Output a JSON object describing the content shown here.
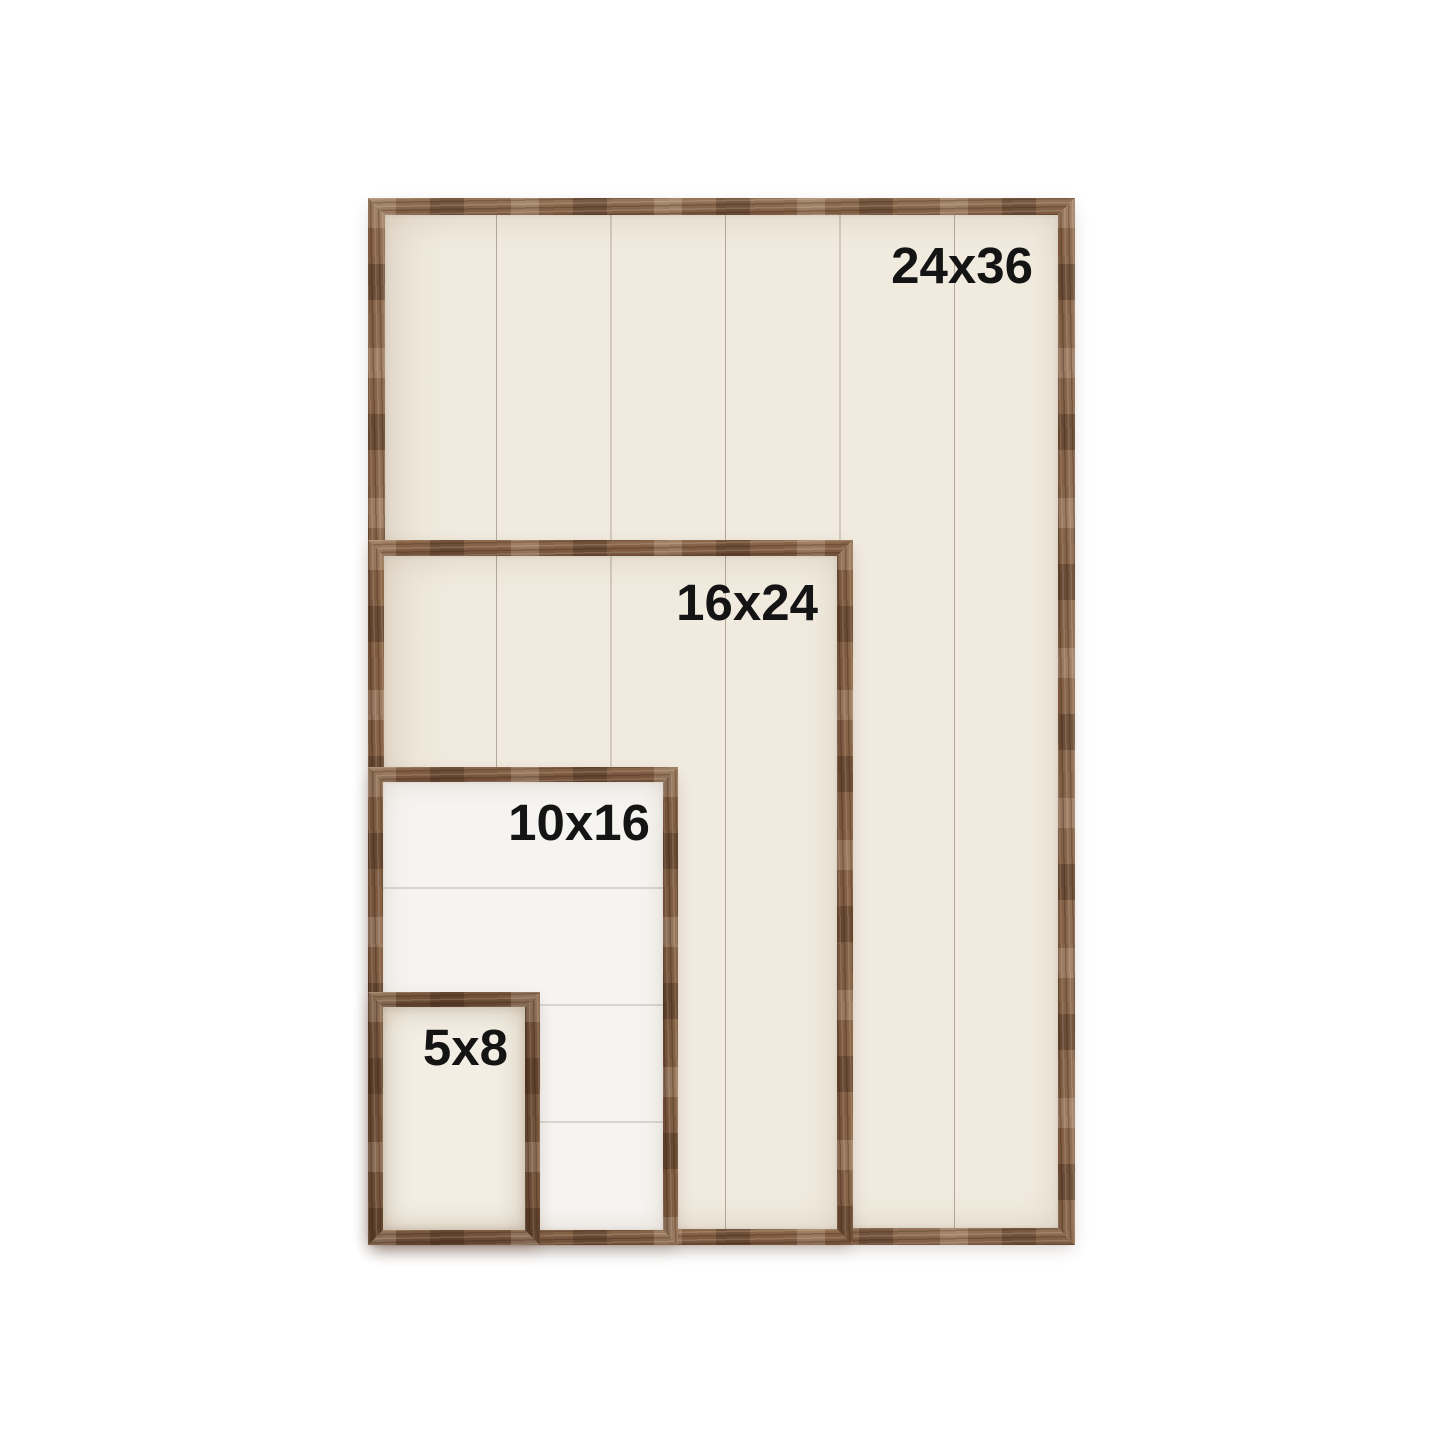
{
  "title": "Wood sign frame size comparison chart",
  "colors": {
    "page_background": "#ffffff",
    "wood_brown": "#7d5a40",
    "panel_cream": "#f1ebdf",
    "panel_white": "#f6f4f1",
    "label_text": "#141414"
  },
  "frames": [
    {
      "id": "24x36",
      "label": "24x36"
    },
    {
      "id": "16x24",
      "label": "16x24"
    },
    {
      "id": "10x16",
      "label": "10x16"
    },
    {
      "id": "5x8",
      "label": "5x8"
    }
  ]
}
